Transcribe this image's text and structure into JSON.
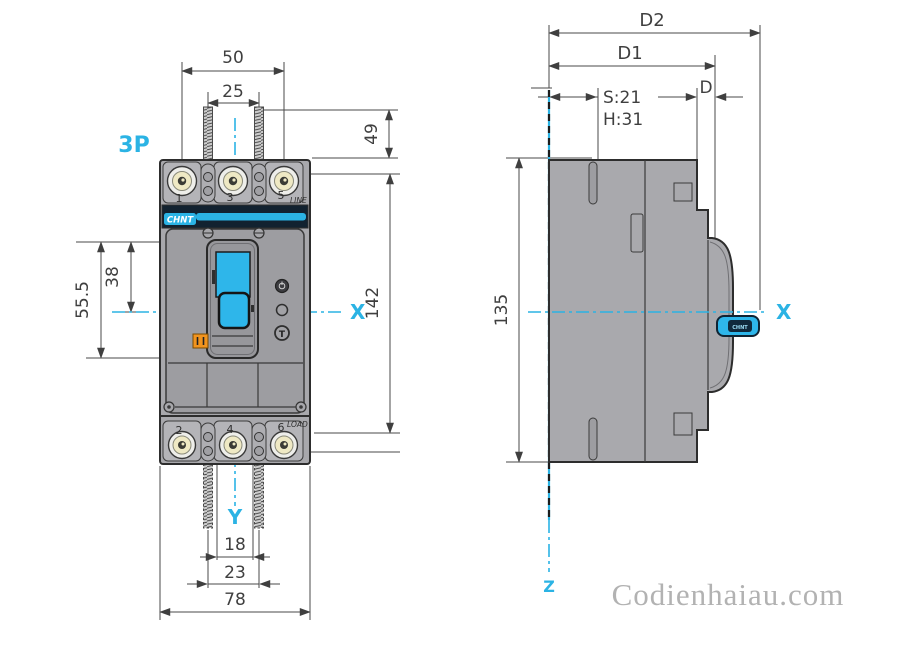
{
  "drawing": {
    "pole_label": "3P",
    "watermark": "Codienhaiau.com"
  },
  "front_view": {
    "axis_labels": {
      "x": "X",
      "y": "Y"
    },
    "brand_logo": "CHNT",
    "line_label": "LINE",
    "load_label": "LOAD",
    "terminals_top": [
      "1",
      "3",
      "5"
    ],
    "terminals_bottom": [
      "2",
      "4",
      "6"
    ],
    "test_button_label": "T",
    "dimensions": {
      "outer_terminal_pitch": "50",
      "terminal_pitch": "25",
      "top_screw_depth": "49",
      "body_height": "142",
      "cover_top_to_center": "38",
      "cover_height": "55.5",
      "slot_width": "18",
      "screw_pitch": "23",
      "body_width": "78"
    }
  },
  "side_view": {
    "axis_labels": {
      "x": "X",
      "z": "Z"
    },
    "handle_label": "CHNT",
    "dimensions": {
      "overall_depth": "D2",
      "depth_to_handle_base": "D1",
      "front_depth": "D",
      "screw_note_line1": "S:21",
      "screw_note_line2": "H:31",
      "body_height": "135"
    }
  },
  "colors": {
    "accent_cyan": "#2bb3e4",
    "body_gray": "#a8a8ac",
    "brand_band_navy": "#122230",
    "toggle_cyan": "#2eb6ea",
    "trip_indicator_orange": "#f2941e",
    "dimension_text": "#3f3f3f",
    "watermark_gray": "#b2b2b2"
  }
}
